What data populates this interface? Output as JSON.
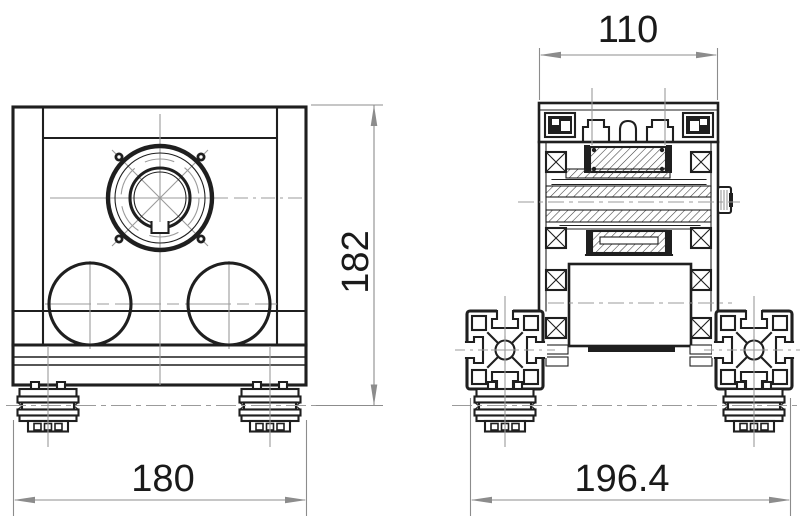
{
  "drawing": {
    "background_color": "#ffffff",
    "line_color": "#1f1f1f",
    "centerline_color": "#9b9b9b",
    "dimension_color": "#8c8c8c",
    "dimension_text_color": "#1a1a1a",
    "dimensions": {
      "front_width": {
        "value": "180",
        "orientation": "horizontal",
        "location": "below-front-view"
      },
      "front_height": {
        "value": "182",
        "orientation": "vertical",
        "location": "right-of-front-view"
      },
      "side_top_width": {
        "value": "110",
        "orientation": "horizontal",
        "location": "above-side-view"
      },
      "side_bottom_width": {
        "value": "196.4",
        "orientation": "horizontal",
        "location": "below-side-view"
      }
    }
  }
}
